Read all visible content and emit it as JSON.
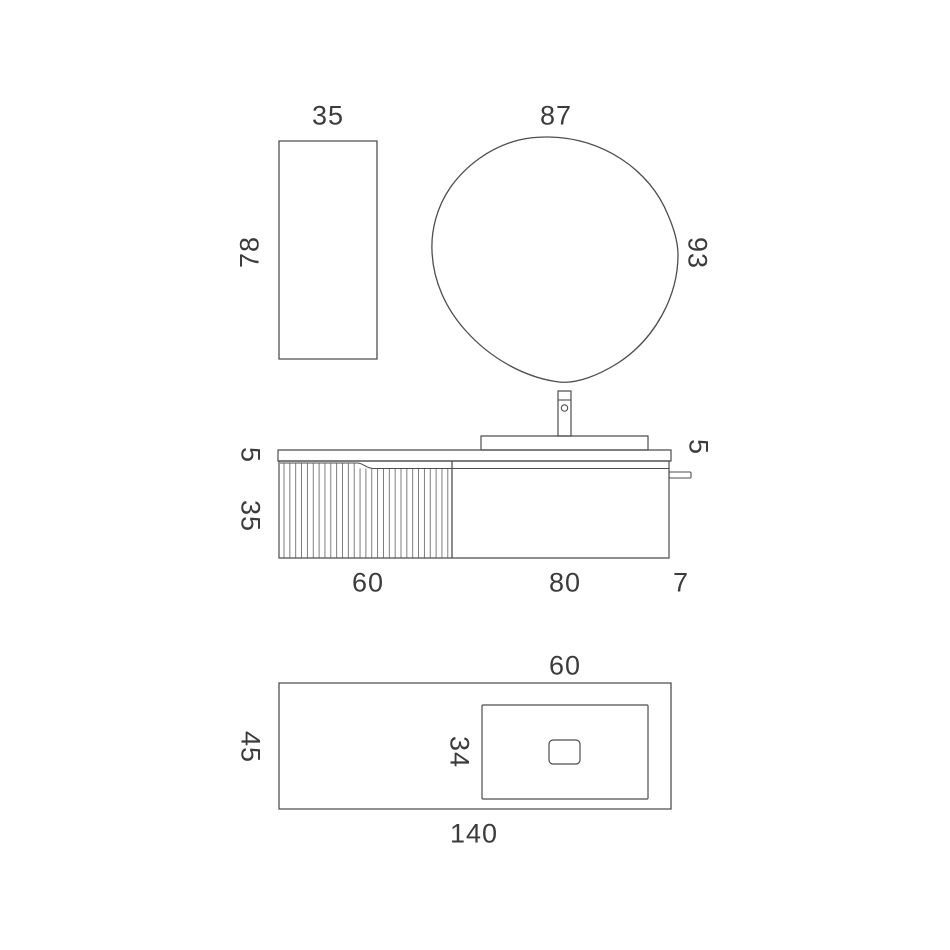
{
  "page": {
    "background": "#ffffff",
    "line_color": "#4d4d4d",
    "flute_line_color": "#6f6f6f",
    "text_color": "#3b3b3b"
  },
  "labels": {
    "side_cabinet_width": "35",
    "side_cabinet_height": "78",
    "mirror_width": "87",
    "mirror_height": "93",
    "countertop_thickness": "5",
    "vanity_height": "35",
    "left_door_width": "60",
    "right_door_width": "80",
    "side_rail_depth": "7",
    "basin_height": "5",
    "basin_width_top": "60",
    "counter_depth": "45",
    "basin_depth": "34",
    "total_width": "140"
  }
}
